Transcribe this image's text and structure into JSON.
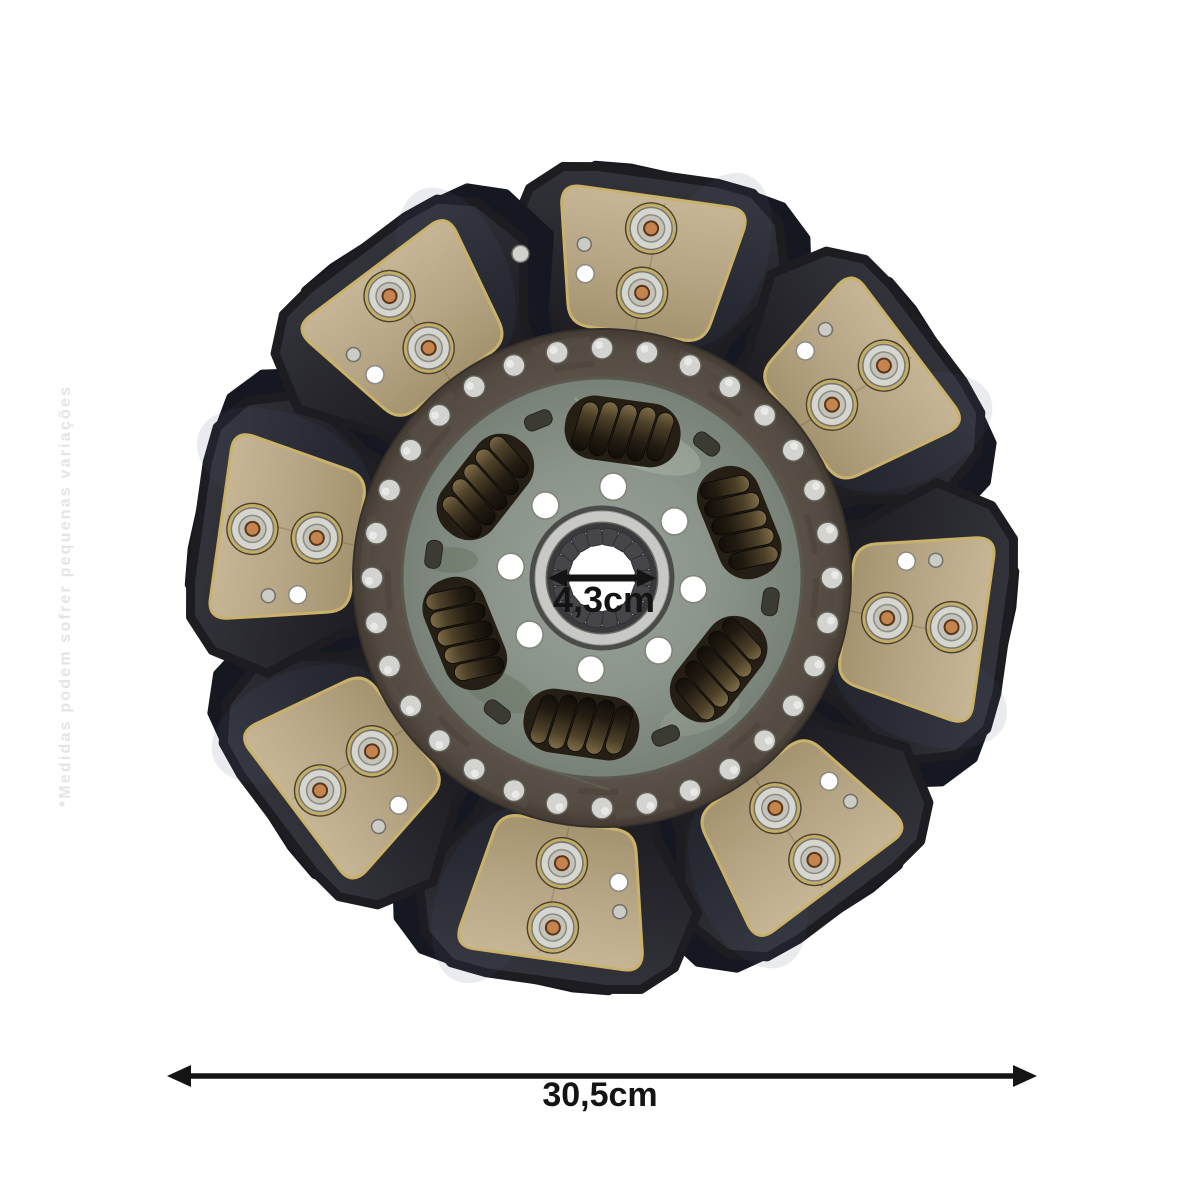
{
  "page": {
    "background": "#ffffff"
  },
  "watermark": {
    "text": "*Medidas podem sofrer pequenas variações",
    "color": "#e4e4e4"
  },
  "dimensions": {
    "hub_bore": {
      "label": "4,3cm"
    },
    "outer_diameter": {
      "label": "30,5cm"
    },
    "color": "#141414"
  },
  "disc": {
    "friction_pads": 8,
    "pad_rivets_per_pad": 2,
    "damper_springs": 6,
    "band_rivets": 32,
    "hub_pin_holes": 8,
    "spline_teeth": 18,
    "colors": {
      "pad": "#b7a687",
      "pad_border": "#c9b169",
      "paddle_plate": "#26262c",
      "carrier_plate": "#8b958b",
      "rivet_band": "#534a41",
      "rivet_silver": "#d3d3cf",
      "rivet_copper": "#c5834d",
      "spring": "#2a2318",
      "hub_collar": "#c8c8c5"
    }
  }
}
